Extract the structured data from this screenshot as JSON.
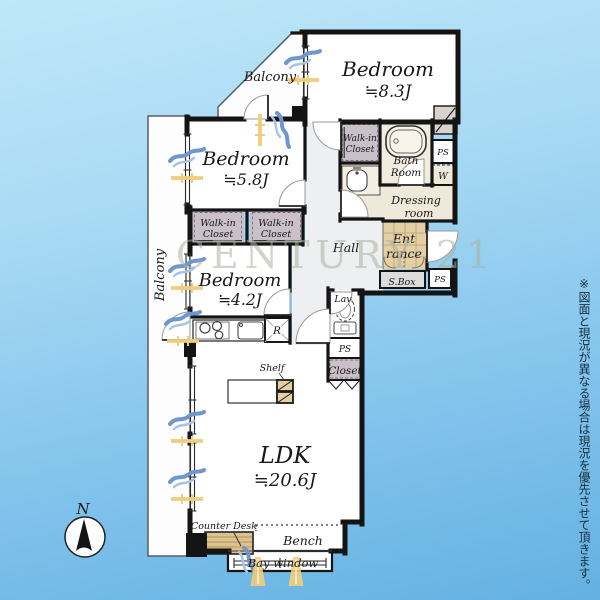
{
  "colors": {
    "background_top": "#bfe7fa",
    "background_bottom": "#64b1e2",
    "wall": "#141414",
    "hall_floor": "#edeff1",
    "closet_floor": "#c9c0c9",
    "wet_area_floor": "#efe9da",
    "entrance_floor": "#e3cfa5",
    "wood": "#dcc28d",
    "breeze_blue": "#6e97cf",
    "light_yellow": "#efcd7e"
  },
  "watermark": {
    "text": "CENTURY 21"
  },
  "disclaimer": {
    "text": "※図面と現況が異なる場合は現況を優先させて頂きます。"
  },
  "compass": {
    "north_label": "N"
  },
  "plan": {
    "rooms": {
      "bedroom_83": {
        "name": "Bedroom",
        "size": "≒8.3J"
      },
      "bedroom_58": {
        "name": "Bedroom",
        "size": "≒5.8J"
      },
      "bedroom_42": {
        "name": "Bedroom",
        "size": "≒4.2J"
      },
      "ldk": {
        "name": "LDK",
        "size": "≒20.6J"
      },
      "hall": {
        "name": "Hall"
      },
      "entrance": {
        "name_line1": "Ent",
        "name_line2": "rance"
      },
      "dressing_room": {
        "name_line1": "Dressing",
        "name_line2": "room"
      },
      "bath_room": {
        "name_line1": "Bath",
        "name_line2": "Room"
      },
      "lavatory": {
        "name": "Lav."
      },
      "walk_in_closet_top": {
        "name_line1": "Walk-in",
        "name_line2": "Closet"
      },
      "walk_in_closet_left": {
        "name_line1": "Walk-in",
        "name_line2": "Closet"
      },
      "walk_in_closet_right": {
        "name_line1": "Walk-in",
        "name_line2": "Closet"
      },
      "closet": {
        "name": "Closet"
      },
      "balcony_top": {
        "name": "Balcony"
      },
      "balcony_left": {
        "name": "Balcony"
      }
    },
    "features": {
      "shoe_box": "S.Box",
      "pipe_space": "PS",
      "washer": "W",
      "refrigerator": "R",
      "shelf": "Shelf",
      "counter_desk": "Counter Desk",
      "bench": "Bench",
      "bay_window": "Bay window"
    }
  }
}
